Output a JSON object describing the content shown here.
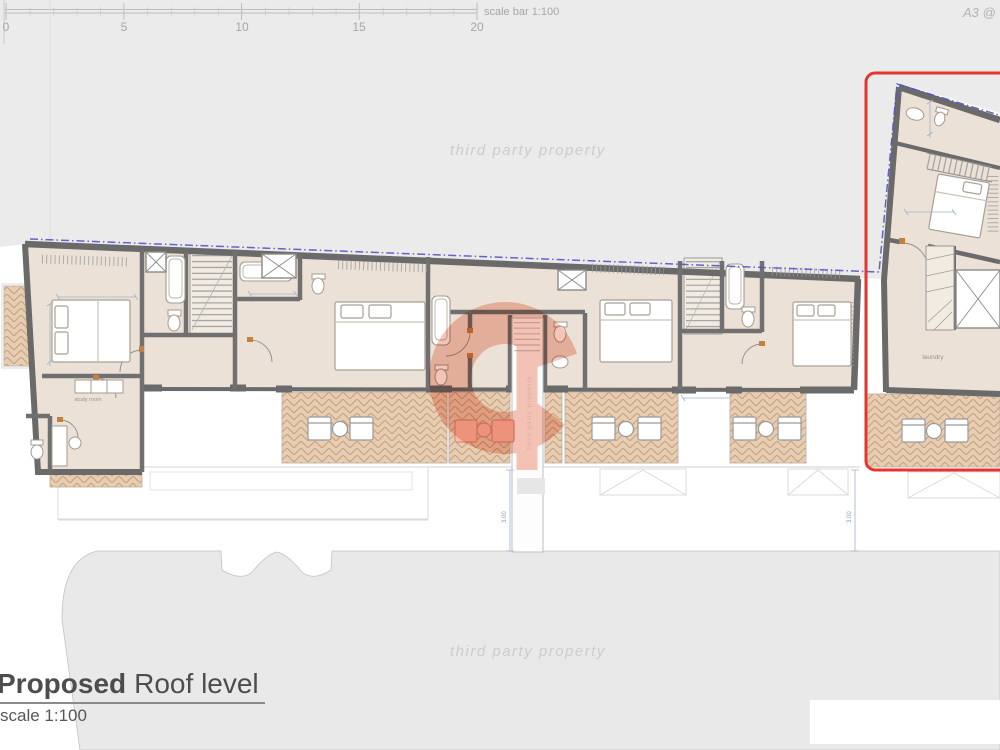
{
  "colors": {
    "accent_red": "#e5352e",
    "boundary_dash_purple": "#5a52c8",
    "logo_salmon": "#ec8a6d",
    "wall_gray": "#6a6a6a",
    "room_beige": "#ece1d6",
    "terrace_tan": "#e7ceb2",
    "terrace_hatch": "#c89f7e",
    "background_gray": "#ebebeb",
    "street_gray": "#e9e9e9",
    "dimension_blue": "#9fb2c9",
    "watermark_gray": "#cccccc"
  },
  "scale_bar": {
    "ticks": [
      "0",
      "5",
      "10",
      "15",
      "20"
    ],
    "label": "scale bar 1:100"
  },
  "sheet_note": "A3 @",
  "watermark": {
    "text_top": "third party property",
    "text_bottom": "third party property",
    "logo_vertical_text": "third party property"
  },
  "plan": {
    "room_labels": {
      "study_room": "study room",
      "laundry": "laundry"
    },
    "dimension_labels": [
      "3.00",
      "3.00"
    ]
  },
  "title_block": {
    "title_bold": "Proposed",
    "title_rest": "Roof level",
    "scale_note": "scale 1:100"
  }
}
